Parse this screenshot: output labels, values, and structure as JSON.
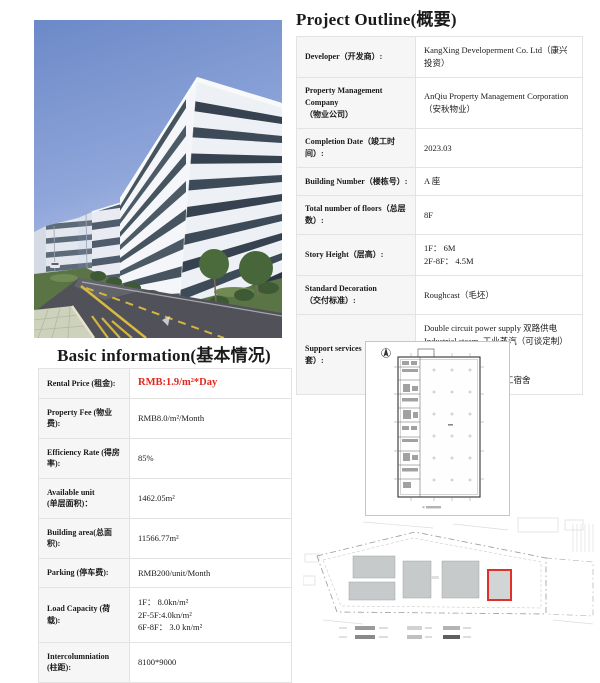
{
  "colors": {
    "accent_red": "#e02820",
    "label_bg": "#f6f6f6",
    "table_border": "#e3e3e3",
    "site_highlight_red": "#e03028"
  },
  "project_outline": {
    "title": "Project Outline(概要)",
    "rows": [
      {
        "label": [
          "Developer（开发商）:"
        ],
        "value": [
          "KangXing Developerment Co. Ltd（康兴投资）"
        ]
      },
      {
        "label": [
          "Property Management Company",
          "（物业公司）"
        ],
        "value": [
          "AnQiu Property Management Corporation（安秋物业）"
        ]
      },
      {
        "label": [
          "Completion Date（竣工时间）:"
        ],
        "value": [
          "2023.03"
        ]
      },
      {
        "label": [
          "Building Number（楼栋号）:"
        ],
        "value": [
          "A 座"
        ]
      },
      {
        "label": [
          "Total number of floors（总层数）:"
        ],
        "value": [
          "8F"
        ]
      },
      {
        "label": [
          "Story Height（层高）:"
        ],
        "value": [
          "1F： 6M",
          "2F-8F： 4.5M"
        ]
      },
      {
        "label": [
          "Standard Decoration",
          "（交付标准）:"
        ],
        "value": [
          "Roughcast（毛坯）"
        ]
      },
      {
        "label": [
          "Support services（园区配套）:"
        ],
        "value": [
          "Double circuit power supply 双路供电",
          "Industrial steam  工业蒸汽（可谈定制）",
          "CVS  便利店",
          "Shuttle bus  接驳班车",
          "Dorm for employees 职工宿舍"
        ]
      }
    ]
  },
  "basic_information": {
    "title": "Basic information(基本情况)",
    "rows": [
      {
        "label": [
          "Rental Price (租金):"
        ],
        "value": [
          "RMB:1.9/m²*Day"
        ],
        "highlight": true
      },
      {
        "label": [
          "Property Fee (物业费):"
        ],
        "value": [
          "RMB8.0/m²/Month"
        ]
      },
      {
        "label": [
          "Efficiency Rate (得房率):"
        ],
        "value": [
          "85%"
        ]
      },
      {
        "label": [
          "Available unit",
          "(单层面积)："
        ],
        "value": [
          "1462.05m²"
        ]
      },
      {
        "label": [
          "Building area(总面积):"
        ],
        "value": [
          "11566.77m²"
        ]
      },
      {
        "label": [
          "Parking (停车费):"
        ],
        "value": [
          "RMB200/unit/Month"
        ]
      },
      {
        "label": [
          "Load Capacity (荷载):"
        ],
        "value": [
          "1F： 8.0kn/m²",
          "2F-5F:4.0kn/m²",
          "6F-8F： 3.0 kn/m²"
        ]
      },
      {
        "label": [
          "Intercolumniation",
          "(柱距):"
        ],
        "value": [
          "8100*9000"
        ]
      }
    ]
  },
  "photo": {
    "description": "Modern 8-storey white office buildings with dark window bands along a landscaped road under a blue sky"
  },
  "floor_plan": {
    "description": "Typical floor plan drawing with service core on the left and open column grid"
  },
  "site_plan": {
    "description": "Site plan of the industrial park with Building A outlined in red"
  }
}
